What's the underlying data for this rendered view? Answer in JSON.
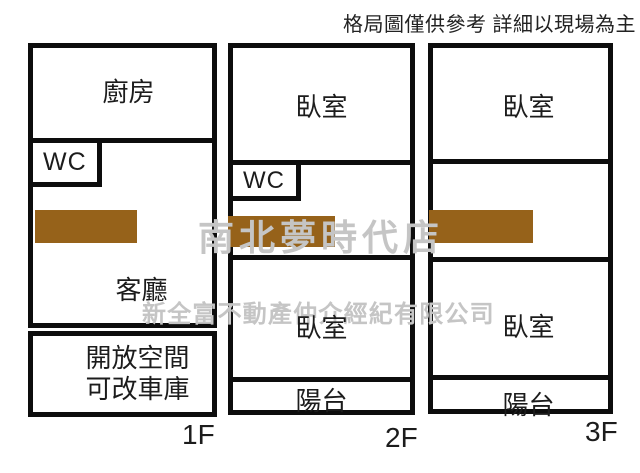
{
  "disclaimer": "格局圖僅供參考 詳細以現場為主",
  "watermark": {
    "line1": "南北夢時代店",
    "line2": "新全富不動產仲介經紀有限公司"
  },
  "colors": {
    "wall": "#0d0d0d",
    "stairs": "#96621a",
    "watermark": "#c5c5c5"
  },
  "floors": [
    {
      "label": "1F",
      "rooms": {
        "kitchen": "廚房",
        "wc": "WC",
        "living": "客廳",
        "open_line1": "開放空間",
        "open_line2": "可改車庫"
      }
    },
    {
      "label": "2F",
      "rooms": {
        "bedroom_top": "臥室",
        "wc": "WC",
        "bedroom_bottom": "臥室",
        "balcony": "陽台"
      }
    },
    {
      "label": "3F",
      "rooms": {
        "bedroom_top": "臥室",
        "bedroom_bottom": "臥室",
        "balcony": "陽台"
      }
    }
  ]
}
